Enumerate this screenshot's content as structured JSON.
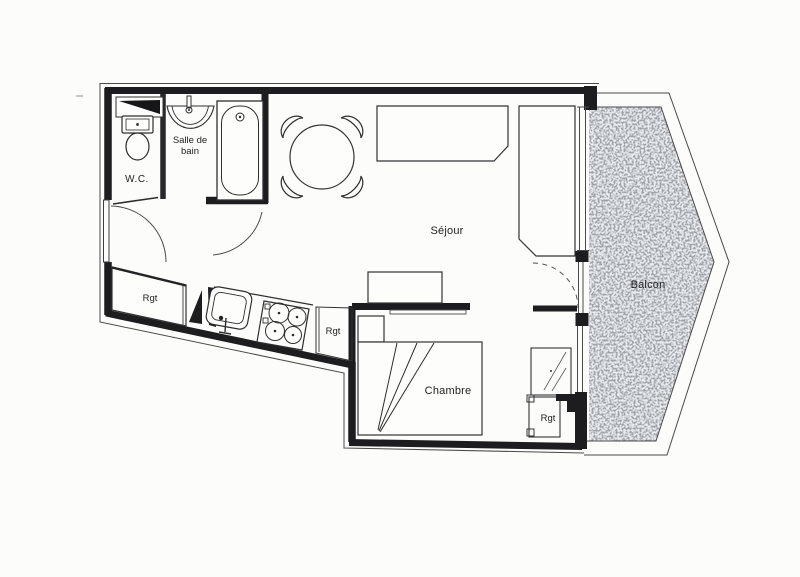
{
  "floorplan": {
    "rooms": {
      "wc": {
        "label": "W.C."
      },
      "bathroom": {
        "label_line1": "Salle de",
        "label_line2": "bain"
      },
      "living": {
        "label": "Séjour"
      },
      "bedroom": {
        "label": "Chambre"
      },
      "balcony": {
        "label": "Balcon"
      }
    },
    "closets": {
      "entry": {
        "label": "Rgt"
      },
      "kitchen": {
        "label": "Rgt"
      },
      "bedroom": {
        "label": "Rgt"
      }
    },
    "colors": {
      "wall": "#1d1d1f",
      "thin_line": "#4a4a4c",
      "balcony_fill": "#e9ecef",
      "speckle": "#565b62",
      "paper": "#fcfcfb",
      "label_text": "#1f1f21"
    }
  }
}
